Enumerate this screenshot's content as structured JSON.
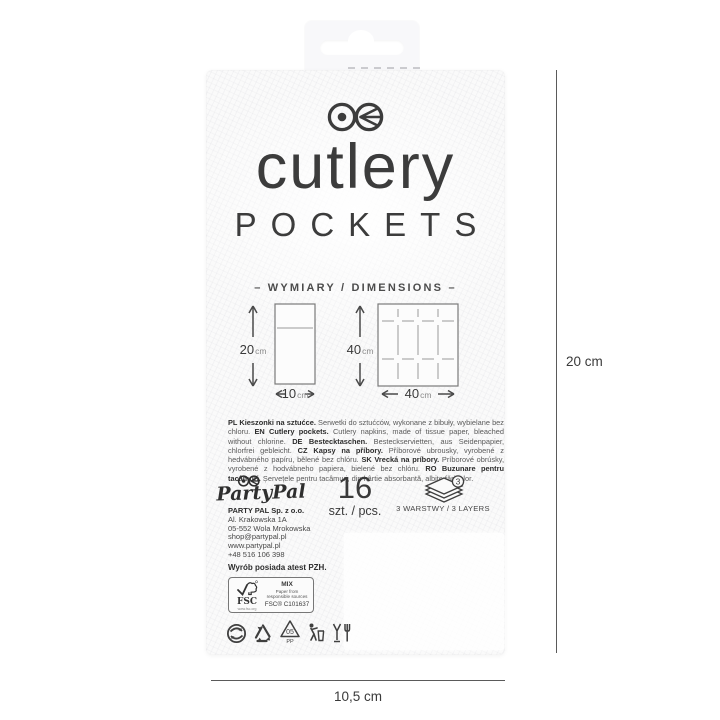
{
  "package": {
    "brand": {
      "title": "cutlery",
      "subtitle": "POCKETS"
    },
    "dimensions": {
      "heading": "–  WYMIARY / DIMENSIONS  –",
      "pocket": {
        "height": "20",
        "height_unit": "cm",
        "width": "10",
        "width_unit": "cm"
      },
      "napkin": {
        "height": "40",
        "height_unit": "cm",
        "width": "40",
        "width_unit": "cm"
      }
    },
    "description_segments": [
      {
        "b": 1,
        "t": "PL Kieszonki na sztućce."
      },
      {
        "b": 0,
        "t": " Serwetki do sztućców, wykonane z bibuły, wybielane bez chloru. "
      },
      {
        "b": 1,
        "t": "EN Cutlery pockets."
      },
      {
        "b": 0,
        "t": " Cutlery napkins, made of tissue paper, bleached without chlorine. "
      },
      {
        "b": 1,
        "t": "DE Bestecktaschen."
      },
      {
        "b": 0,
        "t": " Besteckservietten, aus Seidenpapier, chlorfrei gebleicht. "
      },
      {
        "b": 1,
        "t": "CZ Kapsy na příbory."
      },
      {
        "b": 0,
        "t": " Příborové ubrousky, vyrobené z hedvábného papíru, bělené bez chlóru. "
      },
      {
        "b": 1,
        "t": "SK Vrecká na príbory."
      },
      {
        "b": 0,
        "t": " Príborové obrúsky, vyrobené z hodvábneho papiera, bielené bez chlóru. "
      },
      {
        "b": 1,
        "t": "RO Buzunare pentru tacâmuri."
      },
      {
        "b": 0,
        "t": " Șervețele pentru tacâmuri, din hârtie absorbantă, albite fără clor."
      }
    ],
    "footer": {
      "brand_script": "PartyPal",
      "company_lines": [
        "PARTY PAL Sp. z o.o.",
        "Al. Krakowska 1A",
        "05-552 Wola Mrokowska",
        "shop@partypal.pl",
        "www.partypal.pl",
        "+48 516 106 398"
      ],
      "certificate": "Wyrób posiada atest PZH.",
      "fsc": {
        "acronym": "FSC",
        "website": "www.fsc.org",
        "grade": "MIX",
        "source_line1": "Paper from",
        "source_line2": "responsible sources",
        "code": "FSC® C101637"
      },
      "count": {
        "value": "16",
        "unit": "szt. / pcs."
      },
      "layers": {
        "badge": "3",
        "label": "3 WARSTWY / 3 LAYERS"
      },
      "resin": {
        "number": "05",
        "material": "PP"
      }
    }
  },
  "annotations": {
    "height_label": "20 cm",
    "width_label": "10,5 cm"
  },
  "colors": {
    "ink": "#3c3c3c",
    "bag": "#fafafa",
    "line": "#5a5a5a"
  }
}
